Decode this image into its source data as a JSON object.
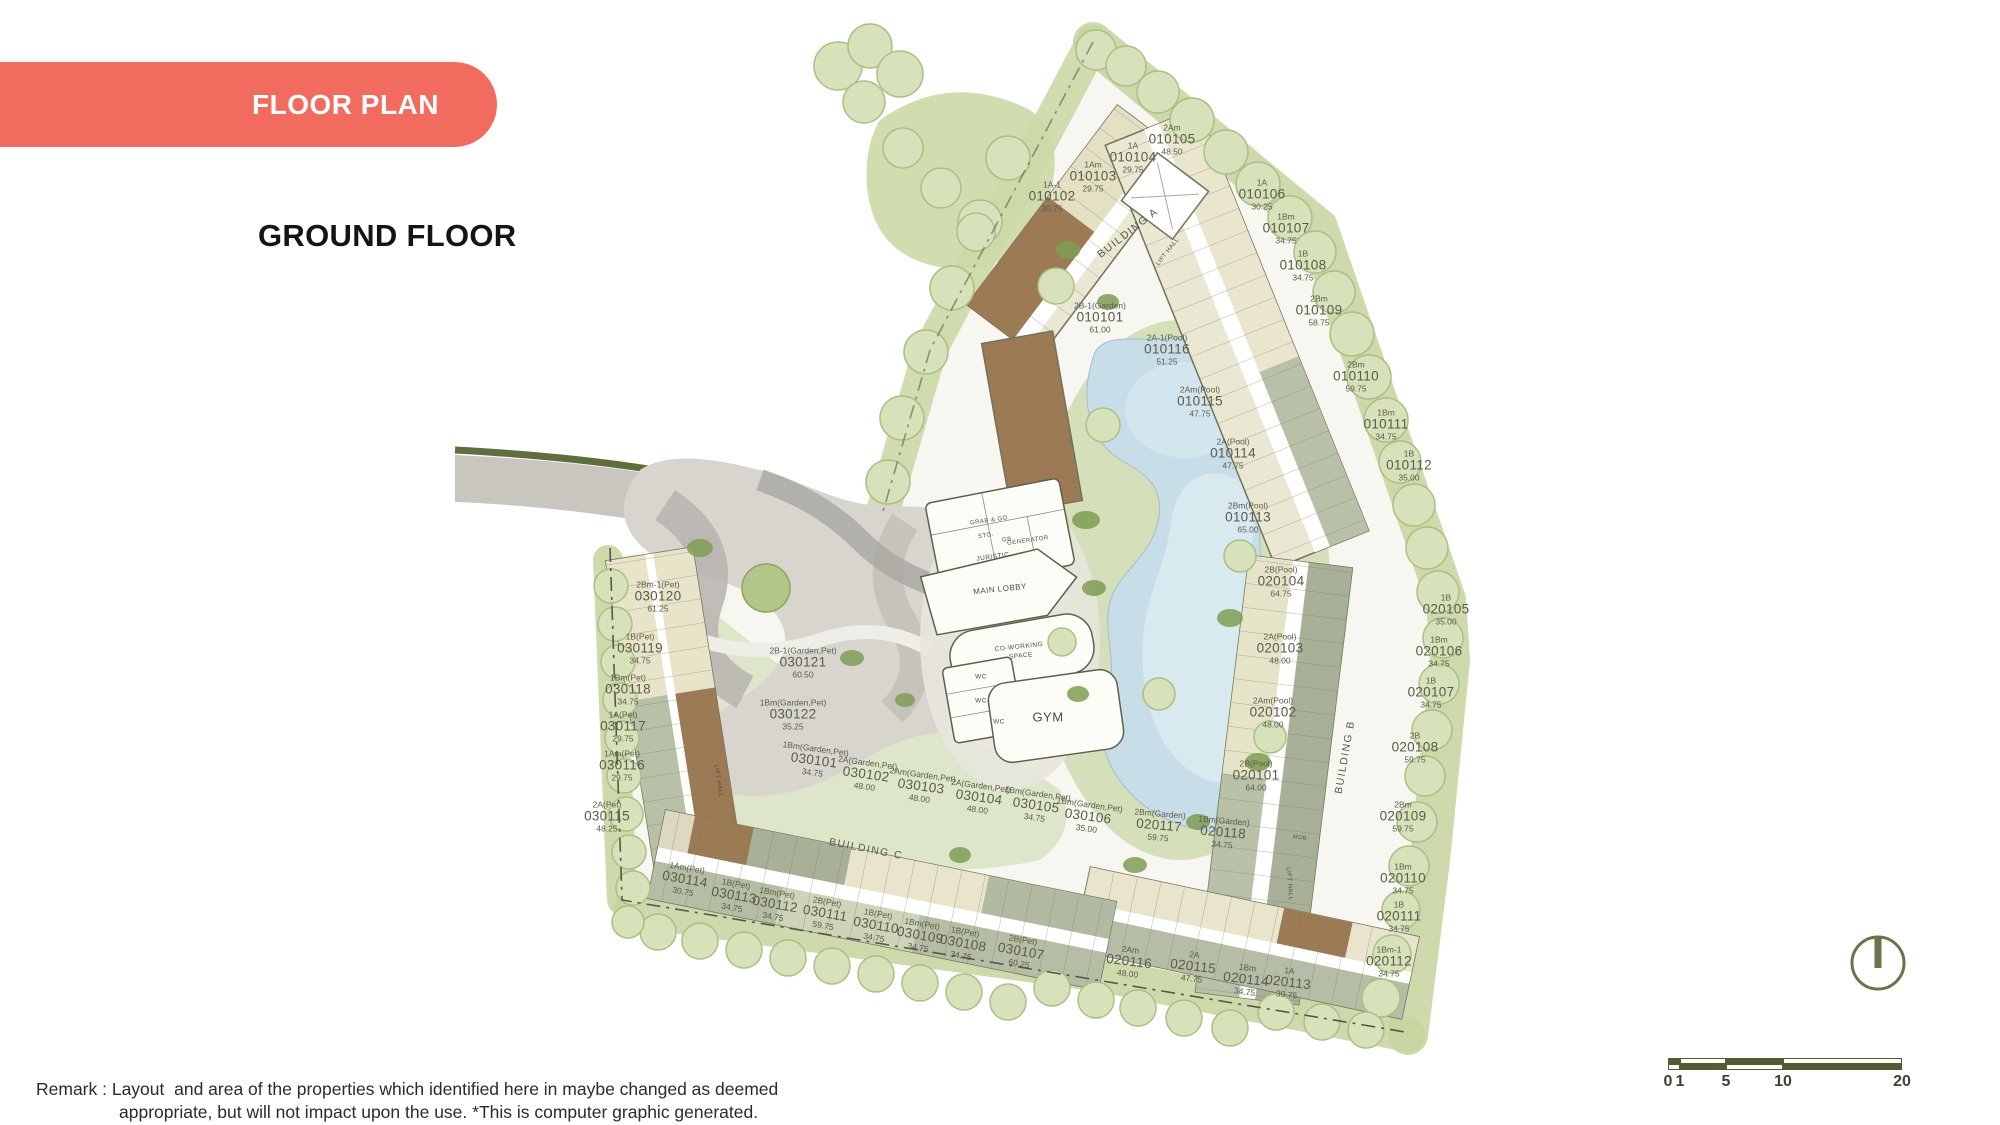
{
  "header": {
    "banner": "FLOOR PLAN",
    "title": "GROUND FLOOR",
    "banner_color": "#f26b5f"
  },
  "remark": {
    "line1": "Remark : Layout  and area of the properties which identified here in maybe changed as deemed",
    "line2": "appropriate, but will not impact upon the use. *This is computer graphic generated."
  },
  "scale_bar": {
    "labels": [
      "0",
      "1",
      "5",
      "10",
      "20"
    ],
    "positions": [
      0,
      12,
      58,
      115,
      234
    ],
    "segment_widths": [
      12,
      46,
      57,
      119
    ],
    "dark_color": "#565b33"
  },
  "compass": {
    "name": "north-indicator",
    "color": "#6d724a"
  },
  "plan": {
    "building_labels": [
      {
        "label": "BUILDING A",
        "x": 1128,
        "y": 233,
        "r": -38
      },
      {
        "label": "BUILDING B",
        "x": 1345,
        "y": 757,
        "r": -80
      },
      {
        "label": "BUILDING C",
        "x": 866,
        "y": 849,
        "r": 11
      }
    ],
    "facilities": [
      {
        "label": "GRAB & GO",
        "x": 989,
        "y": 521,
        "fs": 6,
        "r": -8
      },
      {
        "label": "STO.",
        "x": 986,
        "y": 536,
        "fs": 6,
        "r": -8
      },
      {
        "label": "GB",
        "x": 1007,
        "y": 540,
        "fs": 6,
        "r": -8
      },
      {
        "label": "GENERATOR",
        "x": 1028,
        "y": 541,
        "fs": 6,
        "r": -8
      },
      {
        "label": "JURISTIC",
        "x": 993,
        "y": 557,
        "fs": 6.5,
        "r": -8
      },
      {
        "label": "MAIN LOBBY",
        "x": 1000,
        "y": 589,
        "fs": 8,
        "r": -6
      },
      {
        "label": "CO-WORKING",
        "x": 1019,
        "y": 647,
        "fs": 6.5,
        "r": -6
      },
      {
        "label": "SPACE",
        "x": 1021,
        "y": 656,
        "fs": 6.5,
        "r": -6
      },
      {
        "label": "WC",
        "x": 981,
        "y": 677,
        "fs": 6.5,
        "r": 0
      },
      {
        "label": "WC",
        "x": 981,
        "y": 701,
        "fs": 6.5,
        "r": 0
      },
      {
        "label": "WC",
        "x": 999,
        "y": 722,
        "fs": 6.5,
        "r": 0
      },
      {
        "label": "GYM",
        "x": 1048,
        "y": 717,
        "fs": 13,
        "r": 0
      },
      {
        "label": "LIFT HALL",
        "x": 1168,
        "y": 252,
        "fs": 6,
        "r": -52
      },
      {
        "label": "LIFT HALL",
        "x": 718,
        "y": 781,
        "fs": 6,
        "r": 81
      },
      {
        "label": "LIFT HALL",
        "x": 1289,
        "y": 884,
        "fs": 6,
        "r": 85
      },
      {
        "label": "MOB",
        "x": 1300,
        "y": 838,
        "fs": 5.5,
        "r": 8
      }
    ],
    "units": [
      {
        "no": "010101",
        "type": "2B-1(Garden)",
        "area": "61.00",
        "x": 1100,
        "y": 318,
        "r": 0
      },
      {
        "no": "010102",
        "type": "1A-1",
        "area": "30.75",
        "x": 1052,
        "y": 197,
        "r": 0
      },
      {
        "no": "010103",
        "type": "1Am",
        "area": "29.75",
        "x": 1093,
        "y": 177,
        "r": 0
      },
      {
        "no": "010104",
        "type": "1A",
        "area": "29.75",
        "x": 1133,
        "y": 158,
        "r": 0
      },
      {
        "no": "010105",
        "type": "2Am",
        "area": "48.50",
        "x": 1172,
        "y": 140,
        "r": 0
      },
      {
        "no": "010106",
        "type": "1A",
        "area": "30.25",
        "x": 1262,
        "y": 195,
        "r": 0
      },
      {
        "no": "010107",
        "type": "1Bm",
        "area": "34.75",
        "x": 1286,
        "y": 229,
        "r": 0
      },
      {
        "no": "010108",
        "type": "1B",
        "area": "34.75",
        "x": 1303,
        "y": 266,
        "r": 0
      },
      {
        "no": "010109",
        "type": "2Bm",
        "area": "58.75",
        "x": 1319,
        "y": 311,
        "r": 0
      },
      {
        "no": "010110",
        "type": "2Bm",
        "area": "59.75",
        "x": 1356,
        "y": 377,
        "r": 0
      },
      {
        "no": "010111",
        "type": "1Bm",
        "area": "34.75",
        "x": 1386,
        "y": 425,
        "r": 0
      },
      {
        "no": "010112",
        "type": "1B",
        "area": "35.00",
        "x": 1409,
        "y": 466,
        "r": 0
      },
      {
        "no": "010113",
        "type": "2Bm(Pool)",
        "area": "65.00",
        "x": 1248,
        "y": 518,
        "r": 0
      },
      {
        "no": "010114",
        "type": "2A(Pool)",
        "area": "47.75",
        "x": 1233,
        "y": 454,
        "r": 0
      },
      {
        "no": "010115",
        "type": "2Am(Pool)",
        "area": "47.75",
        "x": 1200,
        "y": 402,
        "r": 0
      },
      {
        "no": "010116",
        "type": "2A-1(Pool)",
        "area": "51.25",
        "x": 1167,
        "y": 350,
        "r": 0
      },
      {
        "no": "020101",
        "type": "2B(Pool)",
        "area": "64.00",
        "x": 1256,
        "y": 776,
        "r": 0
      },
      {
        "no": "020102",
        "type": "2Am(Pool)",
        "area": "48.00",
        "x": 1273,
        "y": 713,
        "r": 0
      },
      {
        "no": "020103",
        "type": "2A(Pool)",
        "area": "48.00",
        "x": 1280,
        "y": 649,
        "r": 0
      },
      {
        "no": "020104",
        "type": "2B(Pool)",
        "area": "64.75",
        "x": 1281,
        "y": 582,
        "r": 0
      },
      {
        "no": "020105",
        "type": "1B",
        "area": "35.00",
        "x": 1446,
        "y": 610,
        "r": 0
      },
      {
        "no": "020106",
        "type": "1Bm",
        "area": "34.75",
        "x": 1439,
        "y": 652,
        "r": 0
      },
      {
        "no": "020107",
        "type": "1B",
        "area": "34.75",
        "x": 1431,
        "y": 693,
        "r": 0
      },
      {
        "no": "020108",
        "type": "2B",
        "area": "59.75",
        "x": 1415,
        "y": 748,
        "r": 0
      },
      {
        "no": "020109",
        "type": "2Bm",
        "area": "59.75",
        "x": 1403,
        "y": 817,
        "r": 0
      },
      {
        "no": "020110",
        "type": "1Bm",
        "area": "34.75",
        "x": 1403,
        "y": 879,
        "r": 0
      },
      {
        "no": "020111",
        "type": "1B",
        "area": "34.75",
        "x": 1399,
        "y": 917,
        "r": 0
      },
      {
        "no": "020112",
        "type": "1Bm-1",
        "area": "34.75",
        "x": 1389,
        "y": 962,
        "r": 0
      },
      {
        "no": "020113",
        "type": "1A",
        "area": "30.75",
        "x": 1288,
        "y": 983,
        "r": 7
      },
      {
        "no": "020114",
        "type": "1Bm",
        "area": "34.75",
        "x": 1246,
        "y": 980,
        "r": 7
      },
      {
        "no": "020115",
        "type": "2A",
        "area": "47.75",
        "x": 1193,
        "y": 967,
        "r": 7
      },
      {
        "no": "020116",
        "type": "2Am",
        "area": "48.00",
        "x": 1129,
        "y": 962,
        "r": 7
      },
      {
        "no": "020117",
        "type": "2Bm(Garden)",
        "area": "59.75",
        "x": 1159,
        "y": 826,
        "r": 5
      },
      {
        "no": "020118",
        "type": "1Bm(Garden)",
        "area": "34.75",
        "x": 1223,
        "y": 833,
        "r": 5
      },
      {
        "no": "030101",
        "type": "1Bm(Garden,Pet)",
        "area": "34.75",
        "x": 814,
        "y": 761,
        "r": 8
      },
      {
        "no": "030102",
        "type": "2A(Garden,Pet)",
        "area": "48.00",
        "x": 866,
        "y": 775,
        "r": 8
      },
      {
        "no": "030103",
        "type": "2Am(Garden,Pet)",
        "area": "48.00",
        "x": 921,
        "y": 787,
        "r": 8
      },
      {
        "no": "030104",
        "type": "2A(Garden,Pet)",
        "area": "48.00",
        "x": 979,
        "y": 798,
        "r": 8
      },
      {
        "no": "030105",
        "type": "1Bm(Garden,Pet)",
        "area": "34.75",
        "x": 1036,
        "y": 806,
        "r": 8
      },
      {
        "no": "030106",
        "type": "1Bm(Garden,Pet)",
        "area": "35.00",
        "x": 1088,
        "y": 817,
        "r": 8
      },
      {
        "no": "030107",
        "type": "2B(Pet)",
        "area": "60.25",
        "x": 1021,
        "y": 952,
        "r": 10
      },
      {
        "no": "030108",
        "type": "1B(Pet)",
        "area": "34.75",
        "x": 963,
        "y": 944,
        "r": 10
      },
      {
        "no": "030109",
        "type": "1Bm(Pet)",
        "area": "34.75",
        "x": 920,
        "y": 936,
        "r": 10
      },
      {
        "no": "030110",
        "type": "1B(Pet)",
        "area": "34.75",
        "x": 876,
        "y": 926,
        "r": 10
      },
      {
        "no": "030111",
        "type": "2B(Pet)",
        "area": "59.75",
        "x": 825,
        "y": 914,
        "r": 10
      },
      {
        "no": "030112",
        "type": "1Bm(Pet)",
        "area": "34.75",
        "x": 775,
        "y": 905,
        "r": 10
      },
      {
        "no": "030113",
        "type": "1B(Pet)",
        "area": "34.75",
        "x": 734,
        "y": 896,
        "r": 10
      },
      {
        "no": "030114",
        "type": "1Am(Pet)",
        "area": "30.75",
        "x": 685,
        "y": 880,
        "r": 10
      },
      {
        "no": "030115",
        "type": "2A(Pet)",
        "area": "48.25",
        "x": 607,
        "y": 817,
        "r": 0
      },
      {
        "no": "030116",
        "type": "1Am(Pet)",
        "area": "29.75",
        "x": 622,
        "y": 766,
        "r": 0
      },
      {
        "no": "030117",
        "type": "1A(Pet)",
        "area": "29.75",
        "x": 623,
        "y": 727,
        "r": 0
      },
      {
        "no": "030118",
        "type": "1Bm(Pet)",
        "area": "34.75",
        "x": 628,
        "y": 690,
        "r": 0
      },
      {
        "no": "030119",
        "type": "1B(Pet)",
        "area": "34.75",
        "x": 640,
        "y": 649,
        "r": 0
      },
      {
        "no": "030120",
        "type": "2Bm-1(Pet)",
        "area": "61.25",
        "x": 658,
        "y": 597,
        "r": 0
      },
      {
        "no": "030121",
        "type": "2B-1(Garden,Pet)",
        "area": "60.50",
        "x": 803,
        "y": 663,
        "r": 0
      },
      {
        "no": "030122",
        "type": "1Bm(Garden,Pet)",
        "area": "35.25",
        "x": 793,
        "y": 715,
        "r": 0
      }
    ]
  }
}
